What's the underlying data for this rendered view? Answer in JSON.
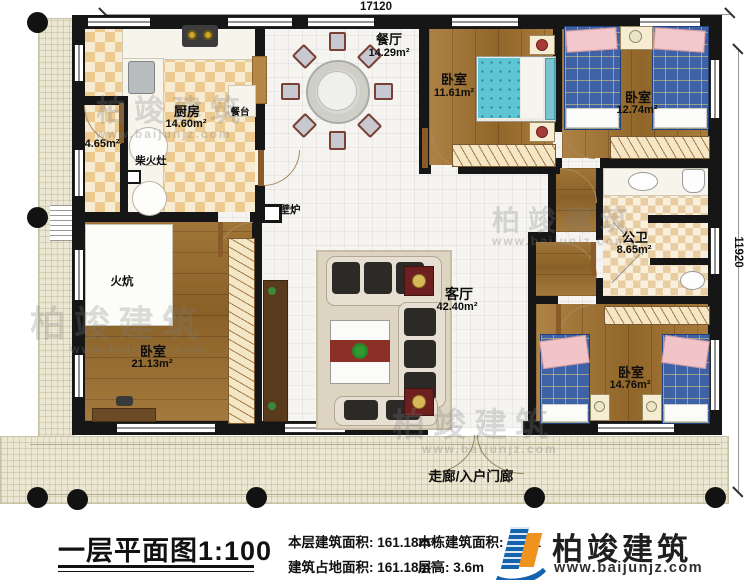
{
  "dimensions": {
    "width_top": "17120",
    "height_right": "11920"
  },
  "rooms": {
    "dining": {
      "name": "餐厅",
      "area": "14.29m²"
    },
    "bedroom_top_left": {
      "name": "卧室",
      "area": "11.61m²"
    },
    "bedroom_top_right": {
      "name": "卧室",
      "area": "12.74m²"
    },
    "kitchen": {
      "name": "厨房",
      "area": "14.60m²"
    },
    "storage": {
      "area": "4.65m²"
    },
    "wood_stove": {
      "name": "柴火灶"
    },
    "counter": {
      "name": "餐台"
    },
    "fireplace": {
      "name": "壁炉"
    },
    "bathroom": {
      "name": "公卫",
      "area": "8.65m²"
    },
    "living": {
      "name": "客厅",
      "area": "42.40m²"
    },
    "kang": {
      "name": "火炕"
    },
    "bedroom_bottom_left": {
      "name": "卧室",
      "area": "21.13m²"
    },
    "bedroom_bottom_right": {
      "name": "卧室",
      "area": "14.76m²"
    },
    "porch": {
      "name": "走廊/入户门廊"
    }
  },
  "caption": {
    "title": "一层平面图1:100",
    "stats": [
      {
        "label": "本层建筑面积:",
        "value": "161.18m²"
      },
      {
        "label": "建筑占地面积:",
        "value": "161.18m²"
      },
      {
        "label": "本栋建筑面积:",
        "value": "161.1"
      },
      {
        "label": "层高:",
        "value": "3.6m"
      }
    ]
  },
  "logo": {
    "name": "柏竣建筑",
    "url": "www.baijunjz.com"
  },
  "watermark": {
    "text": "柏竣建筑",
    "url": "www.baijunjz.com"
  },
  "colors": {
    "wall": "#161616",
    "checker": "#ecca90",
    "wood": "#a5742f",
    "porch": "#ebe7d2",
    "plaid_bed": "#3f62a6",
    "teal_bed": "#5fc4d4",
    "logo_blue": "#1463ae",
    "logo_orange": "#f0921e"
  }
}
